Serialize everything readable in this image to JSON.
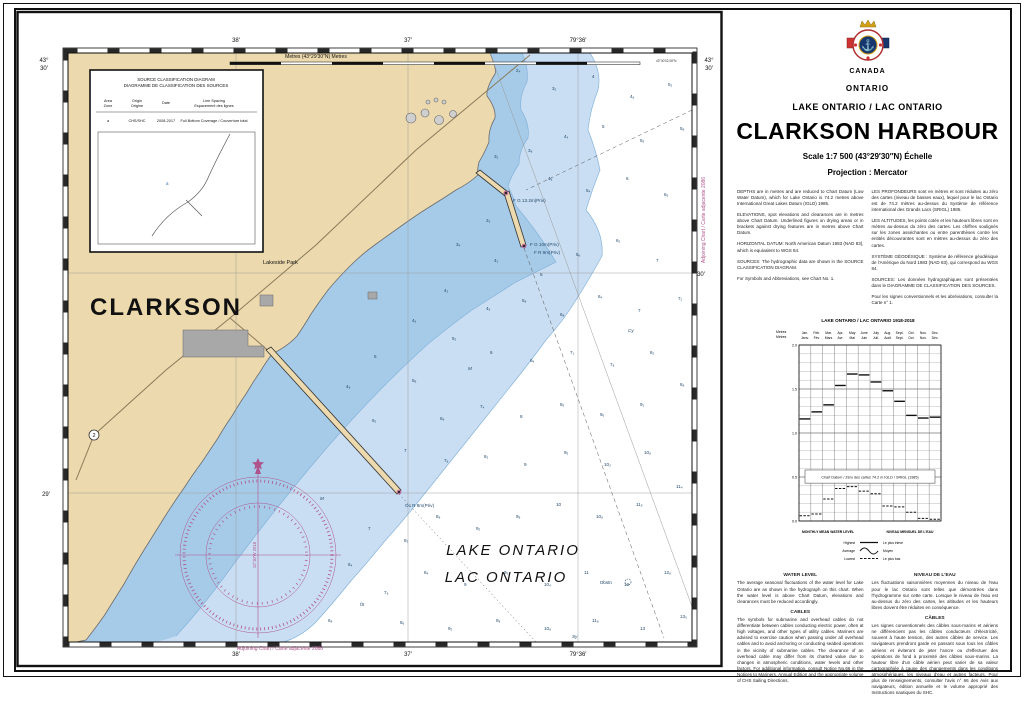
{
  "title_block": {
    "country": "CANADA",
    "province": "ONTARIO",
    "waterbody": "LAKE ONTARIO / LAC ONTARIO",
    "title": "CLARKSON HARBOUR",
    "scale": "Scale 1:7 500 (43°29′30″N) Échelle",
    "projection": "Projection : Mercator"
  },
  "notes": {
    "en": [
      "DEPTHS are in metres and are reduced to Chart Datum (Low Water Datum), which for Lake Ontario is 74.2 metres above International Great Lakes Datum (IGLD) 1985.",
      "ELEVATIONS, spot elevations and clearances are in metres above Chart Datum. Underlined figures on drying areas or in brackets against drying features are in metres above Chart Datum.",
      "HORIZONTAL DATUM: North American Datum 1983 (NAD 83), which is equivalent to WGS 84.",
      "SOURCES: The hydrographic data are shown in the SOURCE CLASSIFICATION DIAGRAM.",
      "For Symbols and Abbreviations, see Chart No. 1."
    ],
    "fr": [
      "LES PROFONDEURS sont en mètres et sont réduites au zéro des cartes (niveau de basses eaux), lequel pour le lac Ontario est de 74.2 mètres au-dessus du Système de référence international des Grands Lacs (SRIGL) 1985.",
      "LES ALTITUDES, les points cotés et les hauteurs libres sont en mètres au-dessus du zéro des cartes. Les chiffres soulignés sur les zones asséchantes ou entre parenthèses contre les entités découvrantes sont en mètres au-dessus du zéro des cartes.",
      "SYSTÈME GÉODÉSIQUE : Système de référence géodésique de l'Amérique du Nord 1983 (NAD 83), qui correspond au WGS 84.",
      "SOURCES: Les données hydrographiques sont présentées dans le DIAGRAMME DE CLASSIFICATION DES SOURCES.",
      "Pour les signes conventionnels et les abréviations, consulter la Carte n° 1."
    ]
  },
  "water_level": {
    "heading_en": "WATER LEVEL",
    "body_en": "The average seasonal fluctuations of the water level for Lake Ontario are as shown in the hydrograph on this chart. When the water level is above Chart Datum, elevations and clearances must be reduced accordingly.",
    "heading_fr": "NIVEAU DE L'EAU",
    "body_fr": "Les fluctuations saisonnières moyennes du niveau de l'eau pour le lac Ontario sont telles que démontrées dans l'hydrogramme sur cette carte. Lorsque le niveau de l'eau est au-dessus du zéro des cartes, les altitudes et les hauteurs libres doivent être réduites en conséquence."
  },
  "cables": {
    "heading_en": "CABLES",
    "body_en": "The symbols for submarine and overhead cables do not differentiate between cables conducting electric power, often at high voltages, and other types of utility cables. Mariners are advised to exercise caution when passing under all overhead cables and to avoid anchoring or conducting seabed operations in the vicinity of submarine cables. The clearance of an overhead cable may differ from its charted value due to changes in atmospheric conditions, water levels and other factors. For additional information, consult Notice No.66 in the Notices to Mariners, Annual Edition and the appropriate volume of CHS Sailing Directions.",
    "heading_fr": "CÂBLES",
    "body_fr": "Les signes conventionnels des câbles sous-marins et aériens ne différencient pas les câbles conducteurs d'électricité, souvent à haute tension, des autres câbles de service. Les navigateurs prendront garde en passant sous tous les câbles aériens et éviteront de jeter l'ancre ou d'effectuer des opérations de fond à proximité des câbles sous-marins. La hauteur libre d'un câble aérien peut varier de sa valeur cartographiée à cause des changements dans les conditions atmosphériques, les niveaux d'eau et autres facteurs. Pour plus de renseignements, consulter l'avis n° 66 des Avis aux navigateurs, édition annuelle et le volume approprié des Instructions nautiques du SHC."
  },
  "chart_data": {
    "type": "line",
    "title": "LAKE ONTARIO / LAC ONTARIO 1918-2018",
    "ylabel_en": "Metres",
    "ylabel_fr": "Mètres",
    "ylim": [
      0.0,
      2.0
    ],
    "ytick_step": 0.5,
    "grid": "on",
    "months_en": [
      "Jan.",
      "Feb.",
      "Mar.",
      "Apr.",
      "May",
      "June",
      "July",
      "Aug.",
      "Sept.",
      "Oct.",
      "Nov.",
      "Dec."
    ],
    "months_fr": [
      "Janv.",
      "Fév.",
      "Mars",
      "Avr.",
      "Mai",
      "Juin",
      "Juil.",
      "Août",
      "Sept.",
      "Oct.",
      "Nov.",
      "Déc."
    ],
    "series": [
      {
        "name": "Highest / Le plus élevé",
        "style": "solid-step",
        "values": [
          1.16,
          1.24,
          1.32,
          1.54,
          1.67,
          1.66,
          1.58,
          1.48,
          1.36,
          1.2,
          1.17,
          1.18
        ]
      },
      {
        "name": "Average / Moyen",
        "style": "curve",
        "values": [
          0.68,
          0.7,
          0.76,
          0.9,
          1.03,
          1.07,
          1.04,
          0.95,
          0.83,
          0.73,
          0.68,
          0.66
        ]
      },
      {
        "name": "Lowest / Le plus bas",
        "style": "dashed-step",
        "values": [
          0.06,
          0.08,
          0.25,
          0.37,
          0.39,
          0.34,
          0.31,
          0.17,
          0.16,
          0.1,
          0.03,
          0.02
        ]
      }
    ],
    "datum_label": "Chart Datum / Zéro des cartes 74.2 m IGLD / SRIGL (1985)",
    "footer_en": "MONTHLY MEAN WATER LEVEL",
    "footer_fr": "NIVEAU MENSUEL DE L'EAU",
    "legend": {
      "highest_en": "Highest",
      "highest_fr": "Le plus élevé",
      "average_en": "Average",
      "average_fr": "Moyen",
      "lowest_en": "Lowest",
      "lowest_fr": "Le plus bas"
    }
  },
  "map": {
    "labels": {
      "clarkson": "CLARKSON",
      "lakeside_park": "Lakeside Park",
      "lake_en": "LAKE ONTARIO",
      "lake_fr": "LAC ONTARIO",
      "obstn": "Obstn",
      "highway": "2",
      "variation": "10°30′W 2018"
    },
    "lights": [
      {
        "x": 497,
        "y": 192,
        "label": "F G 13.2m(Priv)"
      },
      {
        "x": 514,
        "y": 236,
        "label": "F G 10m(Priv)"
      },
      {
        "x": 518,
        "y": 244,
        "label": "F R 9m(Priv)"
      },
      {
        "x": 389,
        "y": 497,
        "label": "Oc R 8m(Priv)"
      }
    ],
    "scalebar_label": "Metres (43°29′30″N) Metres",
    "border_labels": {
      "top": [
        "38′",
        "37′",
        "79°36′"
      ],
      "bottom": [
        "38′",
        "37′",
        "79°36′"
      ],
      "left_lat_deg": "43°",
      "left_lat_min": "30′",
      "left_mid": "29′",
      "right_lat_deg": "43°",
      "right_lat_min": "30′",
      "right_mid": "30′",
      "corner_note": "43°30′02.08″N",
      "adjoining_bottom": "Adjoining Chart / Carte adjacente 2086",
      "adjoining_right": "Adjoining Chart / Carte adjacente 2086"
    },
    "source_diagram": {
      "title1": "SOURCE CLASSIFICATION DIAGRAM",
      "title2": "DIAGRAMME DE CLASSIFICATION DES SOURCES",
      "col1a": "Area",
      "col1b": "Zone",
      "col2a": "Origin",
      "col2b": "Origine",
      "col3": "Date",
      "col4a": "Line Spacing",
      "col4b": "Espacement des lignes",
      "row": {
        "area": "a",
        "origin": "CHS/SHC",
        "date": "2008-2017",
        "spacing": "Full Bottom Coverage / Couverture total"
      },
      "zone_mark": "a"
    },
    "soundings": [
      {
        "x": 500,
        "y": 62,
        "v": "2₄"
      },
      {
        "x": 536,
        "y": 80,
        "v": "3₂"
      },
      {
        "x": 576,
        "y": 68,
        "v": "4"
      },
      {
        "x": 614,
        "y": 88,
        "v": "4₆"
      },
      {
        "x": 652,
        "y": 76,
        "v": "5₂"
      },
      {
        "x": 664,
        "y": 120,
        "v": "5₈"
      },
      {
        "x": 624,
        "y": 132,
        "v": "5₅"
      },
      {
        "x": 586,
        "y": 118,
        "v": "5"
      },
      {
        "x": 548,
        "y": 128,
        "v": "4₄"
      },
      {
        "x": 512,
        "y": 142,
        "v": "3₈"
      },
      {
        "x": 478,
        "y": 148,
        "v": "3₂"
      },
      {
        "x": 532,
        "y": 170,
        "v": "4₈"
      },
      {
        "x": 570,
        "y": 182,
        "v": "5₄"
      },
      {
        "x": 610,
        "y": 170,
        "v": "6"
      },
      {
        "x": 648,
        "y": 186,
        "v": "6₅"
      },
      {
        "x": 470,
        "y": 212,
        "v": "2₉"
      },
      {
        "x": 440,
        "y": 236,
        "v": "3₄"
      },
      {
        "x": 478,
        "y": 252,
        "v": "4₂"
      },
      {
        "x": 524,
        "y": 266,
        "v": "5"
      },
      {
        "x": 560,
        "y": 246,
        "v": "5₆"
      },
      {
        "x": 600,
        "y": 232,
        "v": "6₂"
      },
      {
        "x": 640,
        "y": 252,
        "v": "7"
      },
      {
        "x": 662,
        "y": 290,
        "v": "7₂"
      },
      {
        "x": 622,
        "y": 302,
        "v": "7"
      },
      {
        "x": 582,
        "y": 288,
        "v": "6₄"
      },
      {
        "x": 544,
        "y": 306,
        "v": "6₈"
      },
      {
        "x": 506,
        "y": 292,
        "v": "5₈"
      },
      {
        "x": 470,
        "y": 300,
        "v": "4₉"
      },
      {
        "x": 428,
        "y": 282,
        "v": "4₂"
      },
      {
        "x": 396,
        "y": 312,
        "v": "4₆"
      },
      {
        "x": 436,
        "y": 330,
        "v": "5₂"
      },
      {
        "x": 474,
        "y": 344,
        "v": "6"
      },
      {
        "x": 514,
        "y": 352,
        "v": "6₆"
      },
      {
        "x": 554,
        "y": 344,
        "v": "7₁"
      },
      {
        "x": 594,
        "y": 356,
        "v": "7₈"
      },
      {
        "x": 634,
        "y": 344,
        "v": "8₂"
      },
      {
        "x": 664,
        "y": 376,
        "v": "8₈"
      },
      {
        "x": 624,
        "y": 396,
        "v": "9₁"
      },
      {
        "x": 584,
        "y": 406,
        "v": "9₆"
      },
      {
        "x": 544,
        "y": 396,
        "v": "8₅"
      },
      {
        "x": 504,
        "y": 408,
        "v": "8"
      },
      {
        "x": 464,
        "y": 398,
        "v": "7₄"
      },
      {
        "x": 424,
        "y": 410,
        "v": "6₈"
      },
      {
        "x": 396,
        "y": 372,
        "v": "5₈"
      },
      {
        "x": 358,
        "y": 348,
        "v": "5"
      },
      {
        "x": 330,
        "y": 378,
        "v": "4₈"
      },
      {
        "x": 356,
        "y": 412,
        "v": "6₂"
      },
      {
        "x": 388,
        "y": 442,
        "v": "7"
      },
      {
        "x": 428,
        "y": 452,
        "v": "7₈"
      },
      {
        "x": 468,
        "y": 448,
        "v": "8₂"
      },
      {
        "x": 508,
        "y": 456,
        "v": "9"
      },
      {
        "x": 548,
        "y": 444,
        "v": "9₅"
      },
      {
        "x": 588,
        "y": 456,
        "v": "10₂"
      },
      {
        "x": 628,
        "y": 444,
        "v": "10₈"
      },
      {
        "x": 660,
        "y": 478,
        "v": "11₄"
      },
      {
        "x": 620,
        "y": 496,
        "v": "11₅"
      },
      {
        "x": 580,
        "y": 508,
        "v": "10₈"
      },
      {
        "x": 540,
        "y": 496,
        "v": "10"
      },
      {
        "x": 500,
        "y": 508,
        "v": "9₈"
      },
      {
        "x": 460,
        "y": 520,
        "v": "9₂"
      },
      {
        "x": 420,
        "y": 508,
        "v": "8₈"
      },
      {
        "x": 388,
        "y": 532,
        "v": "8₂"
      },
      {
        "x": 352,
        "y": 520,
        "v": "7"
      },
      {
        "x": 332,
        "y": 556,
        "v": "6₄"
      },
      {
        "x": 368,
        "y": 584,
        "v": "7₈"
      },
      {
        "x": 408,
        "y": 564,
        "v": "8₄"
      },
      {
        "x": 448,
        "y": 576,
        "v": "9"
      },
      {
        "x": 488,
        "y": 564,
        "v": "9₅"
      },
      {
        "x": 528,
        "y": 576,
        "v": "10₄"
      },
      {
        "x": 568,
        "y": 564,
        "v": "11"
      },
      {
        "x": 608,
        "y": 576,
        "v": "12"
      },
      {
        "x": 648,
        "y": 564,
        "v": "12₈"
      },
      {
        "x": 664,
        "y": 608,
        "v": "13₅"
      },
      {
        "x": 624,
        "y": 620,
        "v": "13"
      },
      {
        "x": 576,
        "y": 612,
        "v": "11₈"
      },
      {
        "x": 528,
        "y": 620,
        "v": "10₈"
      },
      {
        "x": 480,
        "y": 612,
        "v": "9₈"
      },
      {
        "x": 432,
        "y": 620,
        "v": "9₂"
      },
      {
        "x": 384,
        "y": 614,
        "v": "8₆"
      },
      {
        "x": 312,
        "y": 612,
        "v": "6₈"
      }
    ],
    "seabed": [
      {
        "x": 452,
        "y": 360,
        "v": "M"
      },
      {
        "x": 612,
        "y": 322,
        "v": "Cy"
      },
      {
        "x": 344,
        "y": 596,
        "v": "fS"
      },
      {
        "x": 556,
        "y": 628,
        "v": "Sy"
      },
      {
        "x": 416,
        "y": 636,
        "v": "Cy"
      },
      {
        "x": 304,
        "y": 490,
        "v": "M"
      }
    ],
    "colors": {
      "land": "#ecd9ad",
      "water_shallow": "#a6cbe9",
      "water_mid": "#c9def2",
      "contour": "#85b3db",
      "magenta": "#b0538c"
    }
  }
}
